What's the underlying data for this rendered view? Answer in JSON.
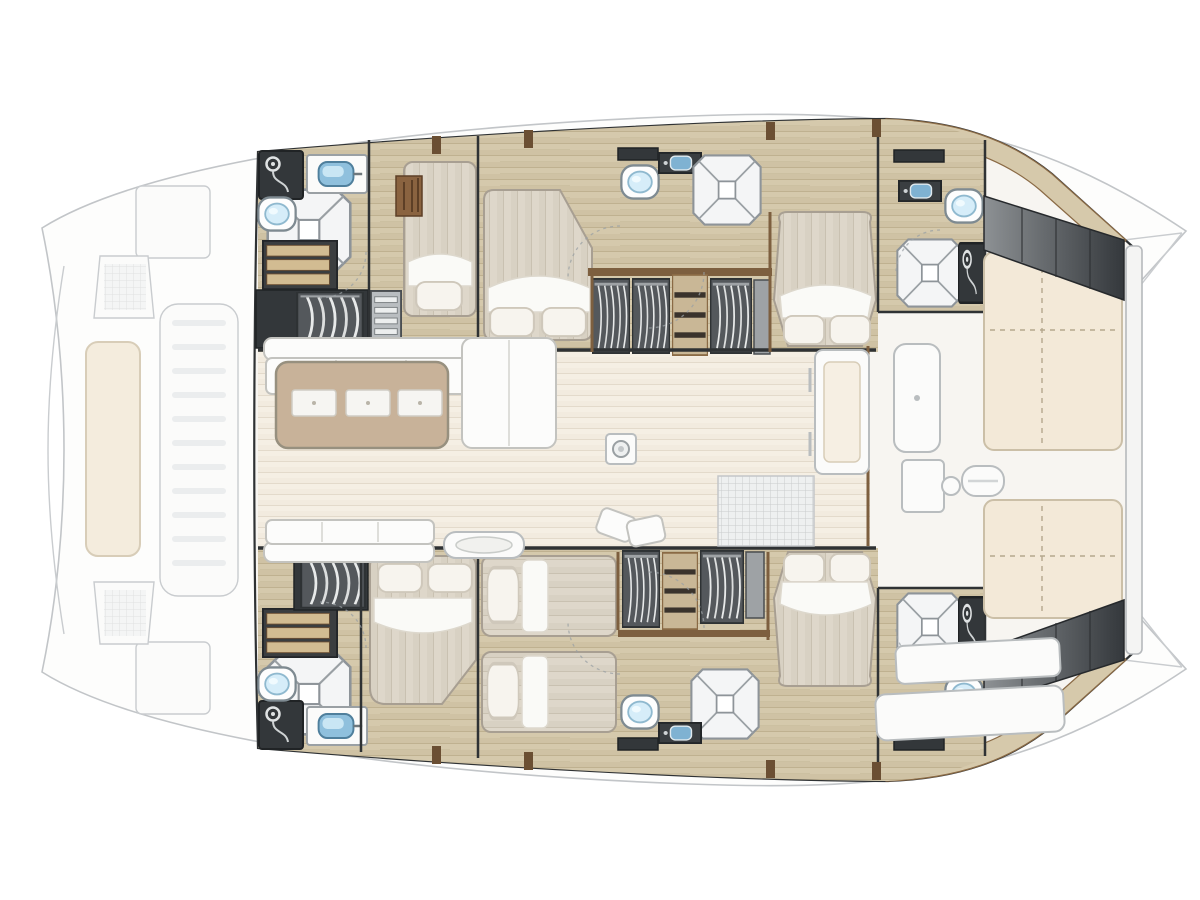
{
  "diagram": {
    "type": "floorplan",
    "subject": "catamaran yacht accommodation deck plan, top-down view",
    "orientation": "bow-left, stern-right; port hull top, starboard hull bottom",
    "areas": {
      "foredeck": [
        "bow-hull-tips",
        "anchor-windlass",
        "foredeck-sunpad",
        "center-walkway",
        "deck-hatches"
      ],
      "port_hull": [
        "forward-head",
        "single-berth-cabin",
        "double-berth-cabin",
        "wardrobe-block",
        "mid-head",
        "aft-double-cabin",
        "aft-head"
      ],
      "saloon": [
        "l-sofa",
        "chaise",
        "dining-table",
        "placemats",
        "aft-sofa",
        "sideboard-console",
        "mast-base",
        "doormat",
        "sliding-door-wall"
      ],
      "starboard_hull": [
        "forward-head",
        "forward-double-cabin",
        "twin-berth-cabin",
        "wardrobe-block",
        "mid-head",
        "aft-double-cabin",
        "aft-head"
      ],
      "aft_cockpit": [
        "cockpit-bench",
        "cockpit-table",
        "grill-module",
        "fender-roll",
        "port-sunpad",
        "starboard-sunpad",
        "transom-steps-port",
        "transom-steps-starboard",
        "davit-post",
        "stern-benches"
      ]
    },
    "counts": {
      "double_beds": 4,
      "single_beds": 3,
      "heads_bathrooms": 6,
      "shower_pans": 6,
      "toilets": 6,
      "sinks": 6,
      "wardrobes": 8,
      "sunpads": 3,
      "placemats": 3,
      "transom_steps": 2
    },
    "colors": {
      "background": "#ffffff",
      "deck_outline": "#c2c5c8",
      "deck_fill": "#fdfdfc",
      "hull_edge": "#2f3234",
      "hull_floor_wood": "#cfc2a4",
      "hull_floor_seam": "#bfb190",
      "saloon_floor": "#f2ebdf",
      "side_deck_wood": "#d6c9ab",
      "dark_fixture": "#33373a",
      "wardrobe_grey": "#54585c",
      "wood_trim": "#7d5f3f",
      "mattress": "#d8d1c3",
      "mattress_stripe": "#c9c1b1",
      "linen_white": "#fafaf7",
      "table_wood": "#c8b299",
      "sofa_white": "#fcfcfb",
      "cushion_cream": "#f3e9d8",
      "steps_dark": "#3a3e42",
      "sink_blue": "#8fc0dd",
      "toilet_blue": "#d6edf9",
      "shower_grey": "#f4f5f6"
    }
  }
}
